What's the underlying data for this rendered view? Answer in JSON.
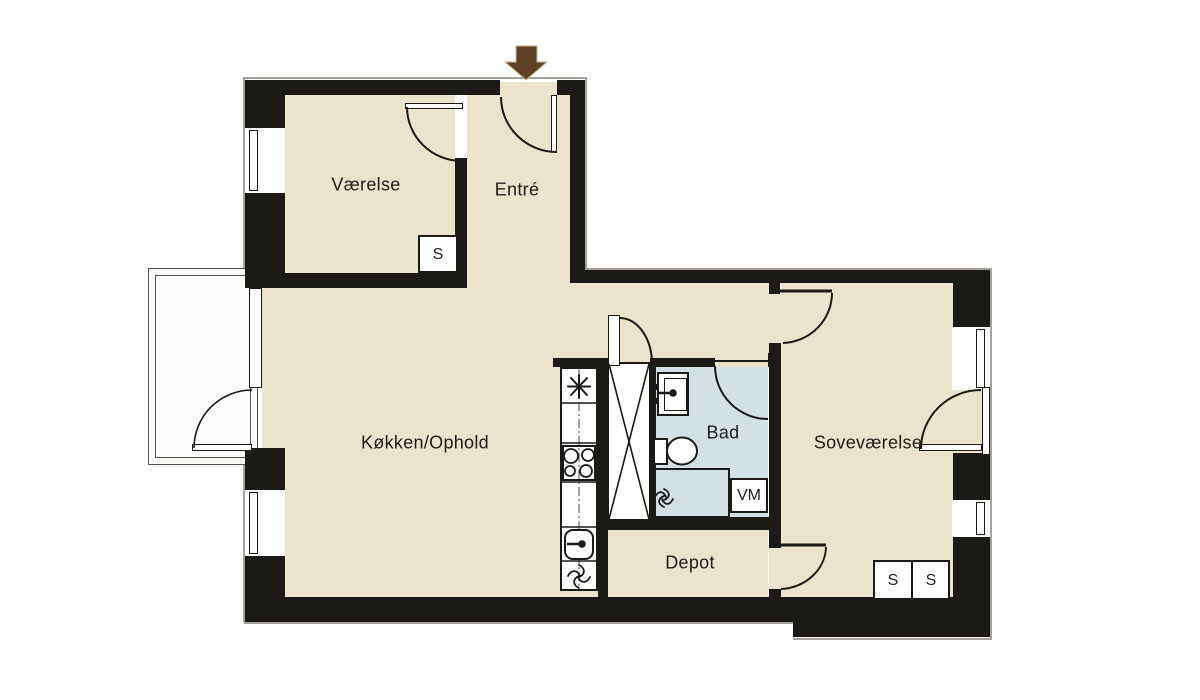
{
  "title": "Apartment floor plan",
  "rooms": {
    "vaerelse": {
      "label": "Værelse"
    },
    "entre": {
      "label": "Entré"
    },
    "kokken_ophold": {
      "label": "Køkken/Ophold"
    },
    "bad": {
      "label": "Bad"
    },
    "sovevaerelse": {
      "label": "Soveværelse"
    },
    "depot": {
      "label": "Depot"
    }
  },
  "fixtures": {
    "closet_label": "S",
    "washing_machine_label": "VM",
    "closet_count": 3
  },
  "colors": {
    "floor": "#ece3cd",
    "bathroom_floor": "#d3e1e5",
    "wall": "#1c1a17",
    "balcony": "#fbfbf9",
    "entrance_arrow": "#5d4127",
    "outline": "#a6a29a"
  }
}
